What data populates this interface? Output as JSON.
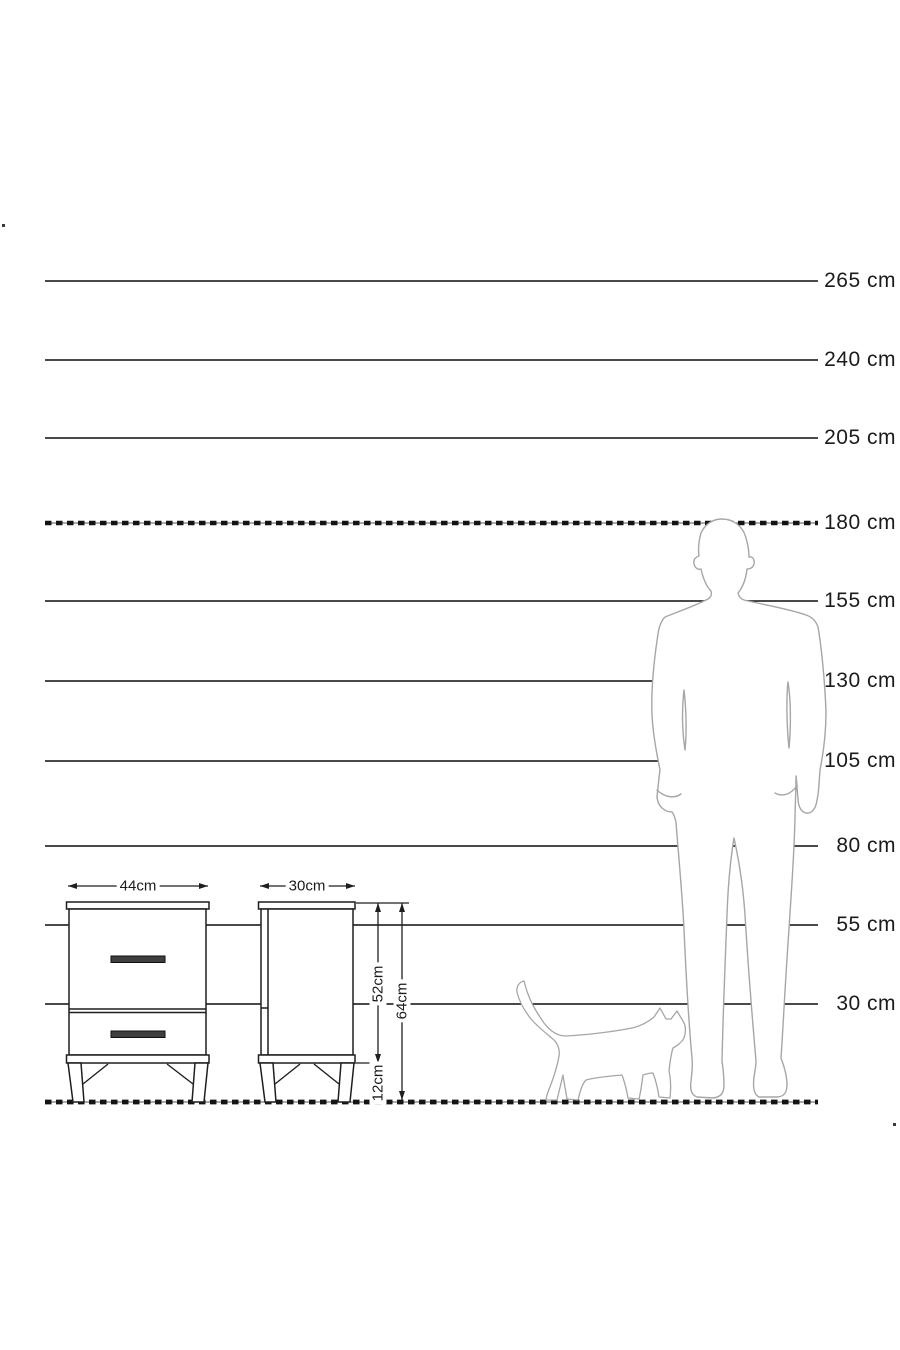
{
  "scale": {
    "labels": [
      "265 cm",
      "240 cm",
      "205 cm",
      "180 cm",
      "155 cm",
      "130 cm",
      "105 cm",
      "80 cm",
      "55 cm",
      "30 cm"
    ],
    "unit": "cm",
    "marks_cm": [
      265,
      240,
      205,
      180,
      155,
      130,
      105,
      80,
      55,
      30
    ],
    "dashed_marks_cm": [
      180,
      0
    ]
  },
  "product": {
    "front_view": {
      "width_label": "44cm"
    },
    "side_view": {
      "depth_label": "30cm",
      "carcass_height_label": "52cm",
      "total_height_label": "64cm",
      "leg_height_label": "12cm"
    },
    "measurements_cm": {
      "width": 44,
      "depth": 30,
      "carcass_height": 52,
      "total_height": 64,
      "leg_height": 12
    }
  },
  "figures": {
    "man": "man-silhouette",
    "cat": "cat-silhouette"
  },
  "colors": {
    "background": "#ffffff",
    "scale_line": "#2f2f2f",
    "dashed_line": "#141414",
    "furniture_line": "#1f1f1f",
    "handle_fill": "#3f3f3f",
    "figure_outline": "#a6a6a6",
    "text": "#1b1b1b"
  }
}
